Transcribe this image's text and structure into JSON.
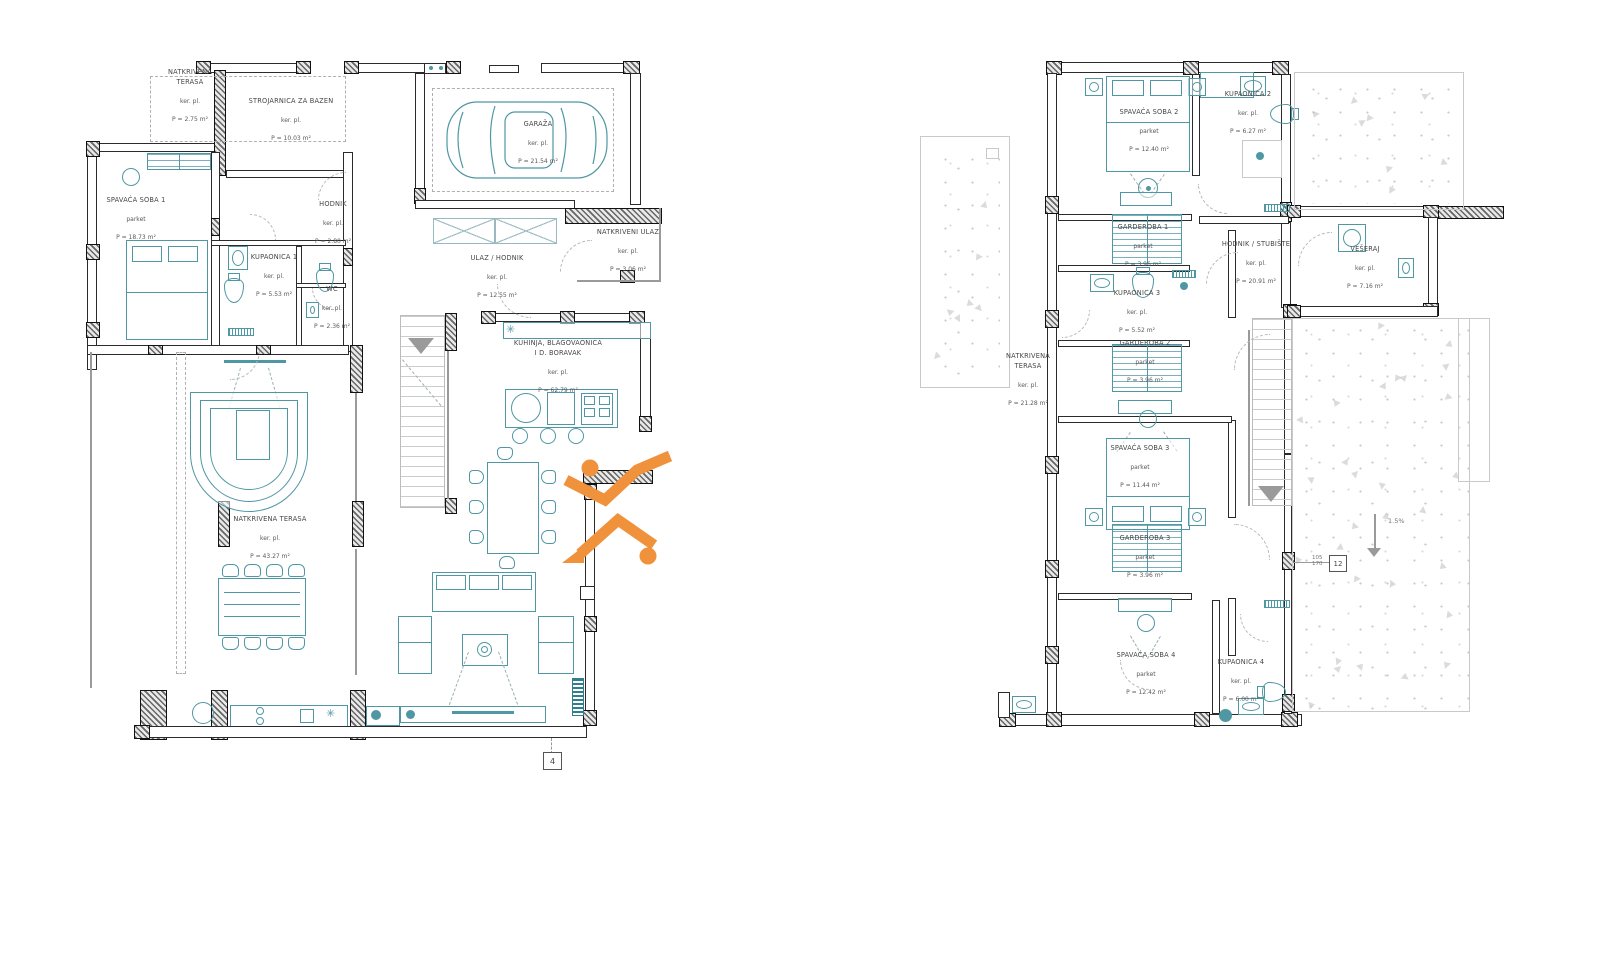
{
  "watermark_color": "#F0913B",
  "left_plan": {
    "rooms": [
      {
        "name": "NATKRIVENA\nTERASA",
        "finish": "ker. pl.",
        "area": "P = 2.75 m²"
      },
      {
        "name": "STROJARNICA ZA BAZEN",
        "finish": "ker. pl.",
        "area": "P = 10.03 m²"
      },
      {
        "name": "GARAŽA",
        "finish": "ker. pl.",
        "area": "P = 21.54 m²"
      },
      {
        "name": "SPAVAĆA SOBA 1",
        "finish": "parket",
        "area": "P = 18.73 m²"
      },
      {
        "name": "HODNIK",
        "finish": "ker. pl.",
        "area": "P = 2.80 m²"
      },
      {
        "name": "KUPAONICA 1",
        "finish": "ker. pl.",
        "area": "P = 5.53 m²"
      },
      {
        "name": "WC",
        "finish": "ker. pl.",
        "area": "P = 2.36 m²"
      },
      {
        "name": "NATKRIVENI ULAZ",
        "finish": "ker. pl.",
        "area": "P = 3.06 m²"
      },
      {
        "name": "ULAZ / HODNIK",
        "finish": "ker. pl.",
        "area": "P = 12.55 m²"
      },
      {
        "name": "KUHINJA, BLAGOVAONICA\nI D. BORAVAK",
        "finish": "ker. pl.",
        "area": "P = 62.79 m²"
      },
      {
        "name": "NATKRIVENA TERASA",
        "finish": "ker. pl.",
        "area": "P = 43.27 m²"
      }
    ],
    "section_marker": "4"
  },
  "right_plan": {
    "rooms": [
      {
        "name": "SPAVAĆA SOBA 2",
        "finish": "parket",
        "area": "P = 12.40 m²"
      },
      {
        "name": "KUPAONICA 2",
        "finish": "ker. pl.",
        "area": "P = 6.27 m²"
      },
      {
        "name": "GARDEROBA 1",
        "finish": "parket",
        "area": "P = 3.96 m²"
      },
      {
        "name": "KUPAONICA 3",
        "finish": "ker. pl.",
        "area": "P = 5.52 m²"
      },
      {
        "name": "HODNIK / STUBIŠTE",
        "finish": "ker. pl.",
        "area": "P = 20.91 m²"
      },
      {
        "name": "VEŠERAJ",
        "finish": "ker. pl.",
        "area": "P = 7.16 m²"
      },
      {
        "name": "NATKRIVENA\nTERASA",
        "finish": "ker. pl.",
        "area": "P = 21.28 m²"
      },
      {
        "name": "GARDEROBA 2",
        "finish": "parket",
        "area": "P = 3.96 m²"
      },
      {
        "name": "SPAVAĆA SOBA 3",
        "finish": "parket",
        "area": "P = 11.44 m²"
      },
      {
        "name": "GARDEROBA 3",
        "finish": "parket",
        "area": "P = 3.96 m²"
      },
      {
        "name": "SPAVAĆA SOBA 4",
        "finish": "parket",
        "area": "P = 12.42 m²"
      },
      {
        "name": "KUPAONICA 4",
        "finish": "ker. pl.",
        "area": "P = 6.00 m²"
      }
    ],
    "slope_label": "1.5%",
    "detail_marker": "12",
    "detail_dims": "105\n170"
  }
}
